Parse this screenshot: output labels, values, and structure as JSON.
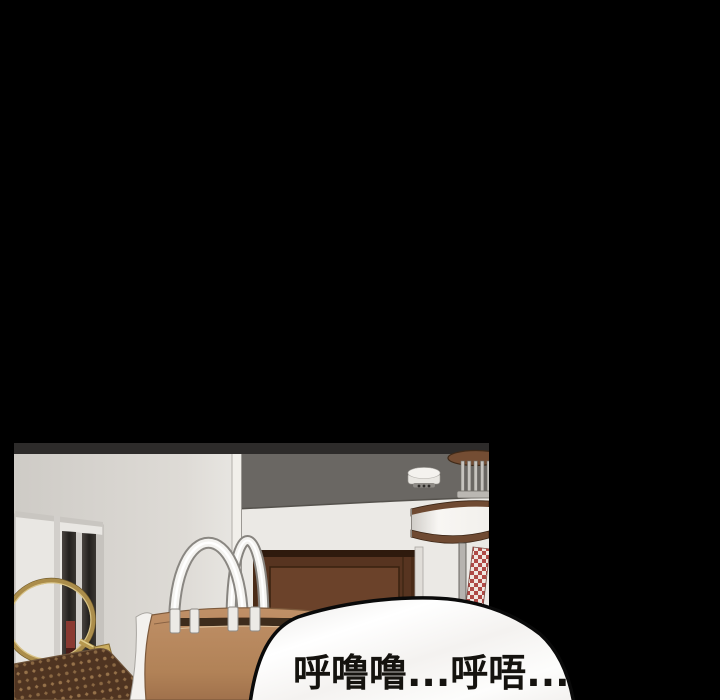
{
  "page": {
    "background_color": "#000000"
  },
  "panel": {
    "scene_objects": [
      "ceiling",
      "left-wall",
      "back-wall",
      "display-cabinet",
      "red-object-in-cabinet",
      "gold-ring-handle",
      "monogram-bag",
      "gold-strap",
      "leather-handbag",
      "handbag-handles",
      "wooden-door",
      "door-jamb",
      "smoke-detector",
      "pendant-lamp",
      "checkered-strip"
    ],
    "colors": {
      "ceiling": "#6a6763",
      "back_wall": "#ebe9e5",
      "left_wall": "#d8d5d0",
      "door_wood": "#5f3a23",
      "handbag_tan": "#b78a60",
      "monogram_brown": "#4f3421",
      "gold": "#b8994f",
      "lamp_trim": "#6f4a32",
      "checker_red": "#b04a46"
    }
  },
  "speech_bubble": {
    "text": "呼噜噜...呼唔...",
    "fill": "#fbfaf9",
    "outline_color": "#0a0a0a",
    "text_color": "#15130f"
  }
}
